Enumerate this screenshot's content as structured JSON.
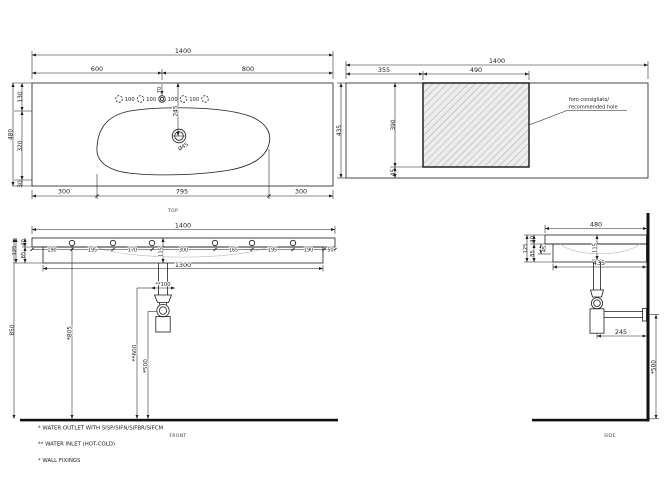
{
  "colors": {
    "line": "#1c1c1c",
    "background": "#ffffff",
    "hatch_fill": "#ededed",
    "hatch_line": "#9e9e9e"
  },
  "top_view": {
    "caption": "TOP",
    "overall_width": "1400",
    "tap_span_left": "600",
    "tap_span_right": "800",
    "tap_edge_offset": "70",
    "tap_hole_spacings": [
      "100",
      "100",
      "100",
      "100"
    ],
    "drain_offset": "245",
    "drain_diameter": "Ø45",
    "depth_back": "130",
    "depth_middle": "320",
    "depth_total": "480",
    "depth_front": "30",
    "bowl_left_offset": "300",
    "bowl_width": "795",
    "bowl_right_offset": "300"
  },
  "cutout_view": {
    "overall_width": "1400",
    "cutout_left_offset": "355",
    "cutout_width": "490",
    "overall_depth": "435",
    "cutout_depth": "390",
    "cutout_front_gap": "45",
    "note_line1": "foro consigliato/",
    "note_line2": "recommended hole"
  },
  "front_view": {
    "caption": "FRONT",
    "overall_width": "1400",
    "fixing_spacings": [
      "190",
      "195",
      "170",
      "300",
      "165",
      "195",
      "190",
      "50"
    ],
    "bowl_depth": "115",
    "rim_thickness": "40",
    "apron_height": "85",
    "front_height": "125",
    "apron_width": "1300",
    "inlet_spacing": "**100",
    "rim_floor_height": "850",
    "fixing_floor_height": "*805",
    "inlet_floor_height": "**600",
    "outlet_floor_height": "*500"
  },
  "side_view": {
    "caption": "SIDE",
    "overall_depth": "480",
    "rim_thickness": "40",
    "front_height": "125",
    "apron_height": "85",
    "bowl_drop": "45",
    "bowl_depth": "115",
    "apron_depth": "435",
    "trap_wall_offset": "245",
    "outlet_floor_height": "*500"
  },
  "footnotes": [
    "*  WATER OUTLET WITH SISP/SIFN/SIFBR/SIFCM",
    "** WATER INLET  (HOT-COLD)",
    "*  WALL FIXINGS"
  ]
}
